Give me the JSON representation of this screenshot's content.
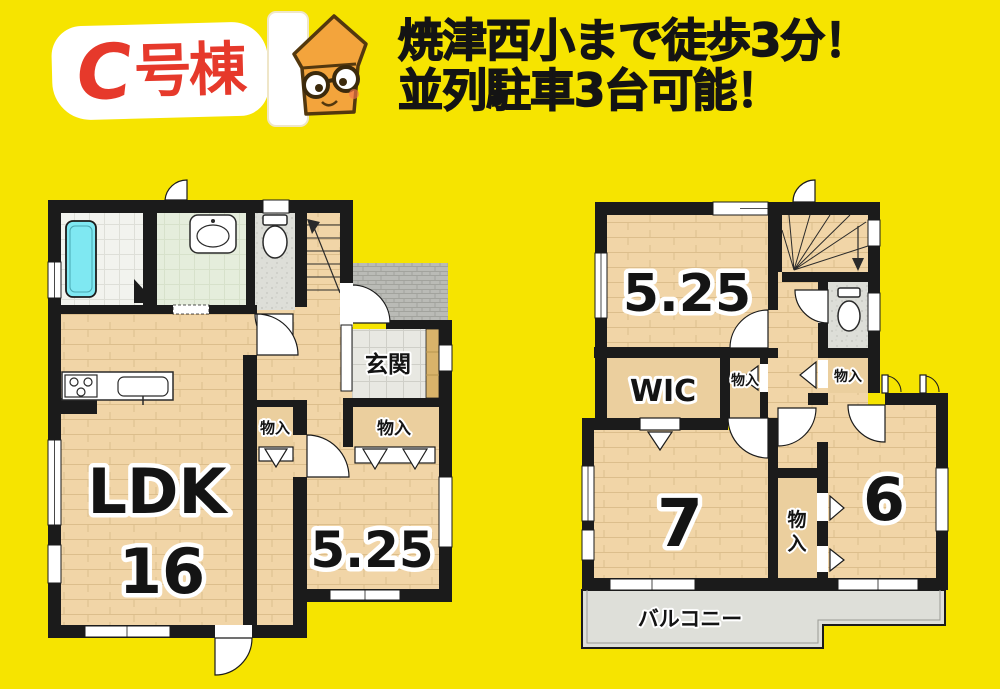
{
  "page": {
    "background": "#F6E400"
  },
  "header": {
    "badge": {
      "letter": "C",
      "suffix": "号棟"
    },
    "headline_line1": "焼津西小まで徒歩3分！",
    "headline_line2": "並列駐車3台可能！"
  },
  "floor1": {
    "ldk_label": "LDK",
    "ldk_size": "16",
    "room_label": "5.25",
    "entrance_label": "玄関",
    "storage_hall_label": "物入",
    "storage_room_label": "物入"
  },
  "floor2": {
    "room_label": "5.25",
    "wic_label": "WIC",
    "storage_left_label": "物入",
    "storage_right_label": "物入",
    "room7_label": "7",
    "room6_label": "6",
    "storage_bottom_char1": "物",
    "storage_bottom_char2": "入",
    "balcony_label": "バルコニー"
  },
  "colors": {
    "background": "#F6E400",
    "badge_text": "#E6392B",
    "headline_text": "#141414",
    "wall": "#1B1B1B",
    "wood_floor": "#F0D3A5",
    "closet_floor": "#EBCF9E",
    "bathtub": "#7FE8F2",
    "washroom_floor": "#E5EDDC",
    "tile_floor": "#E8E8E2",
    "porch_floor": "#BABBB6",
    "balcony_floor": "#DEDFD9",
    "mascot_body": "#F3A43C"
  }
}
